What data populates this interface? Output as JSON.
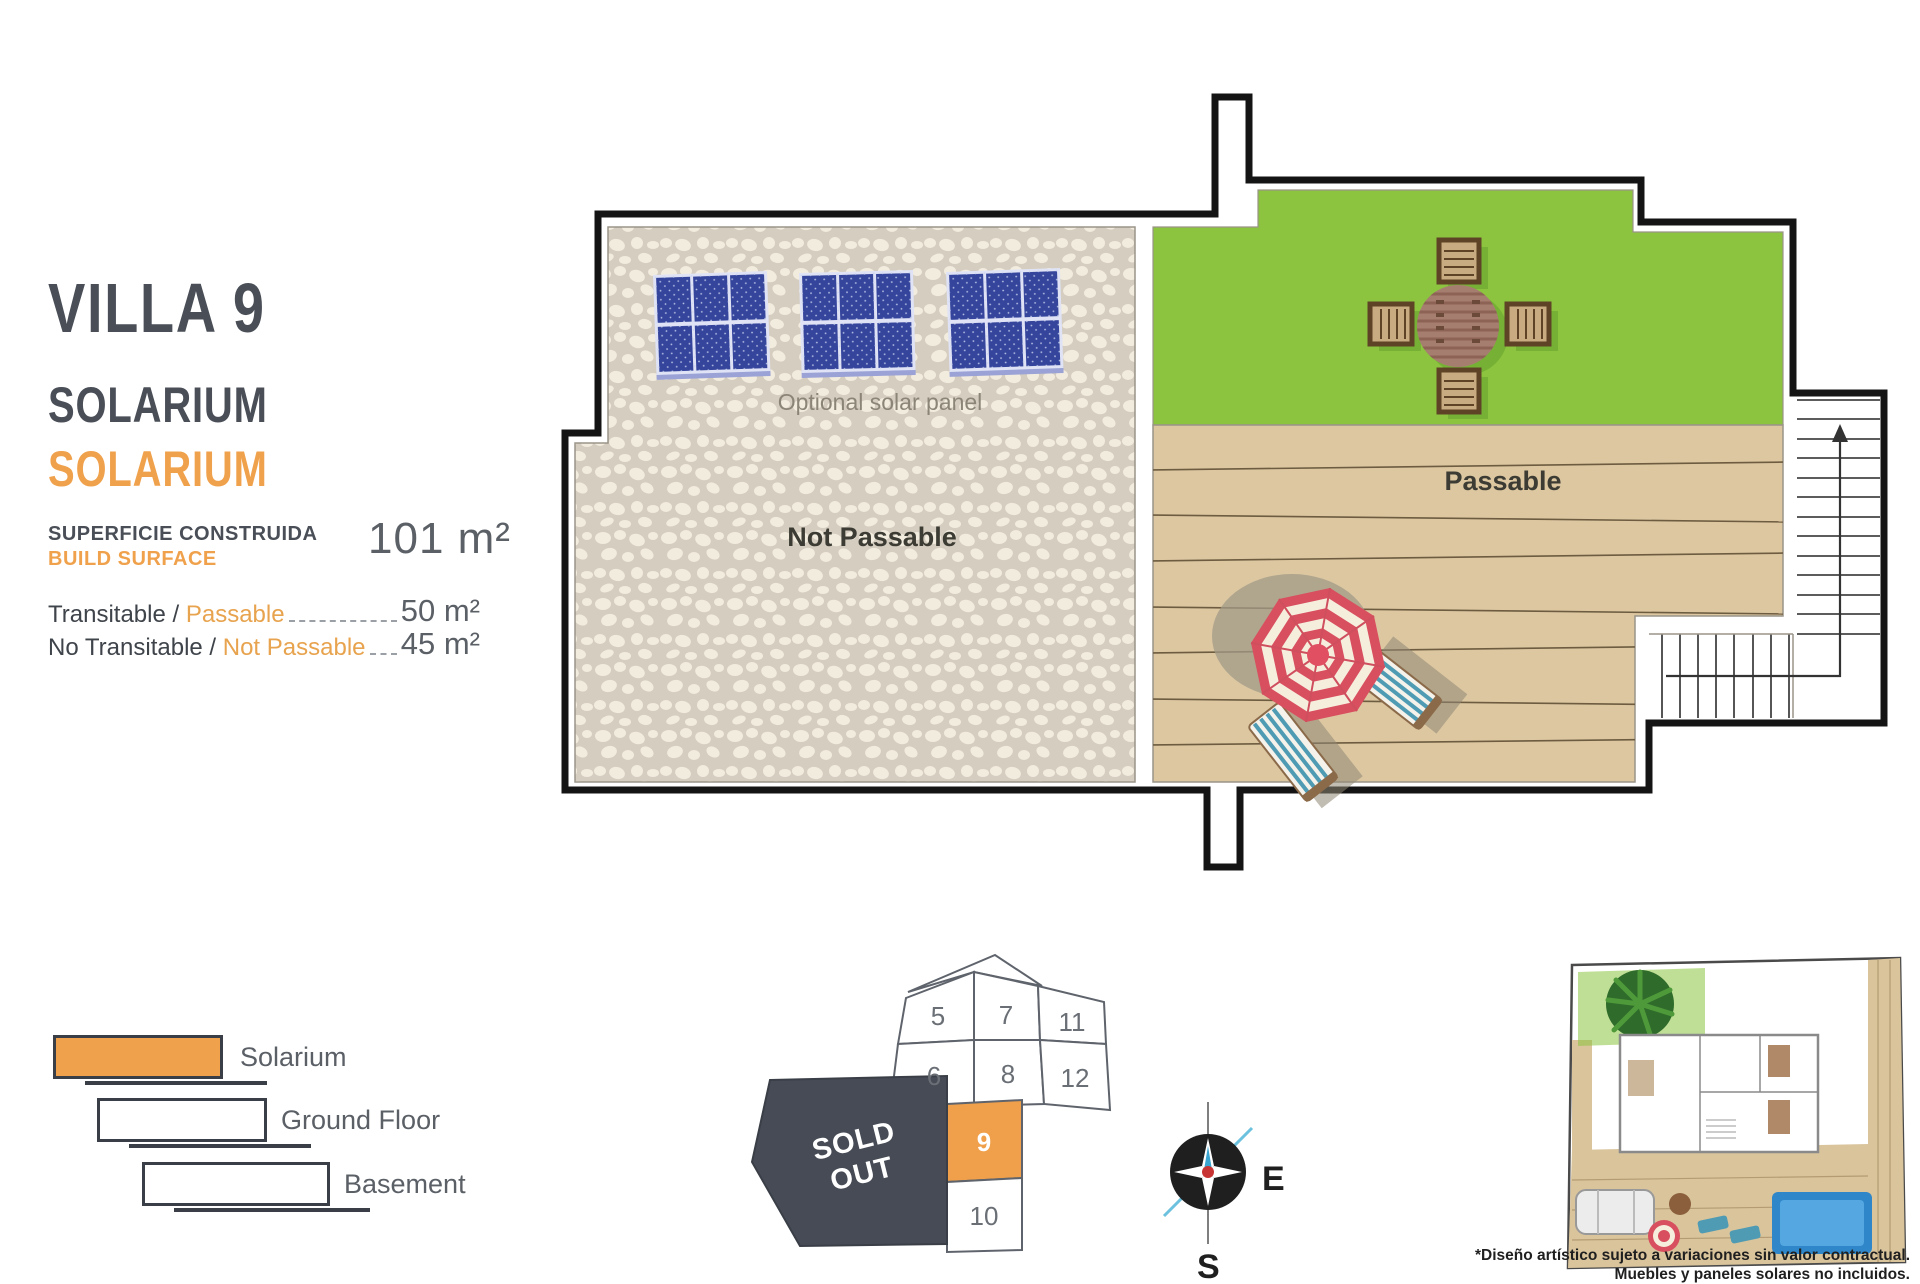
{
  "info_panel": {
    "title": "VILLA 9",
    "subtitle_primary": "SOLARIUM",
    "subtitle_accent": "SOLARIUM",
    "surface_label_es": "SUPERFICIE CONSTRUIDA",
    "surface_label_en": "BUILD SURFACE",
    "surface_value": "101 m²",
    "rows": [
      {
        "label_primary": "Transitable / ",
        "label_accent": "Passable",
        "value": "50 m²"
      },
      {
        "label_primary": "No Transitable / ",
        "label_accent": "Not Passable",
        "value": "45 m²"
      }
    ]
  },
  "legend": {
    "items": [
      {
        "label": "Solarium"
      },
      {
        "label": "Ground Floor"
      },
      {
        "label": "Basement"
      }
    ]
  },
  "plan": {
    "labels": {
      "optional_solar": "Optional solar panel",
      "not_passable": "Not Passable",
      "passable": "Passable"
    }
  },
  "lot_map": {
    "sold_out": [
      "SOLD",
      "OUT"
    ],
    "highlighted_lot": "9",
    "lots": [
      {
        "id": "5"
      },
      {
        "id": "7"
      },
      {
        "id": "11"
      },
      {
        "id": "6"
      },
      {
        "id": "8"
      },
      {
        "id": "12"
      },
      {
        "id": "9"
      },
      {
        "id": "10"
      }
    ]
  },
  "compass": {
    "east": "E",
    "south": "S"
  },
  "disclaimer": {
    "line1": "*Diseño artístico sujeto a variaciones sin valor contractual.",
    "line2": "Muebles y paneles solares no incluidos."
  },
  "colors": {
    "accent_orange": "#f0a14c",
    "slate_text": "#494e57",
    "lawn_green": "#8cc43f",
    "deck_tan": "#dcc7a1",
    "stone_bg": "#d5cdbf",
    "panel_blue": "#35459c",
    "umbrella_red": "#d84f5f",
    "sold_out_bg": "#464b55",
    "lot_highlight": "#f0a04a",
    "wall_black": "#141414",
    "pool_blue": "#2f86c8"
  }
}
